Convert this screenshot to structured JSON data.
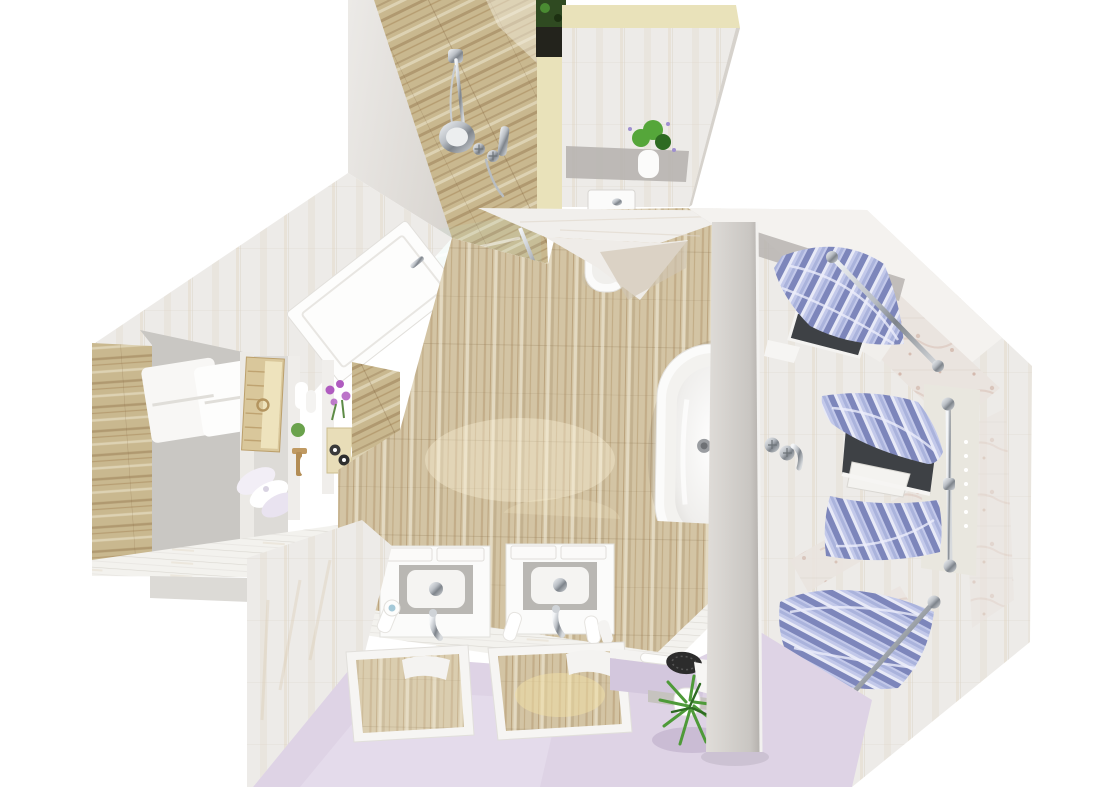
{
  "scene": {
    "title": "Top-down 3D render of an attic bathroom floor plan",
    "view": "bird's-eye / plan perspective",
    "objects": {
      "shower": {
        "label": "walk-in shower with wood-plank wall and chrome shower set"
      },
      "glass_screen": {
        "label": "glass shower screen with chrome rails"
      },
      "wc": {
        "label": "WC compartment with toilet, cistern and potted plant"
      },
      "door": {
        "label": "open white interior door"
      },
      "storage": {
        "label": "open storage shelving with towels, wicker basket and bath accessories"
      },
      "wood_floor": {
        "label": "wood plank bathroom floor"
      },
      "bathtub": {
        "label": "white freestanding bathtub with chrome drain"
      },
      "partition": {
        "label": "partition wall with wall-mounted chrome bath faucet"
      },
      "window_bay": {
        "label": "octagonal window bay with three windows"
      },
      "curtains": {
        "label": "lavender striped swag curtains on chrome rods"
      },
      "vanities": {
        "label": "two white washbasin vanity cabinets with chrome taps"
      },
      "mirrors": {
        "label": "two white framed mirrors reflecting the wood wall"
      },
      "lavender_floor": {
        "label": "pale lavender floor area"
      },
      "bench": {
        "label": "low bench with hairbrush, towel and potted green plant"
      }
    }
  },
  "colors": {
    "bg": "#ffffff",
    "wall_slab": "#e3dfda",
    "pale_tile": "#edebe8",
    "tile_streak": "#d9c8b0",
    "wood_floor": "#d3c4a4",
    "wood_grain": "#a8895c",
    "wood_wall": "#c9b88f",
    "wood_dark": "#8a6c42",
    "cream_band": "#e9e2ba",
    "dark_tile": "#23231c",
    "foliage_dark": "#2f4a21",
    "plant_green": "#55a63a",
    "plant_deep": "#2e6b22",
    "lavender_floor": "#ded3e5",
    "lavender_light": "#eae2f0",
    "counter": "#f3f2ee",
    "counter_line": "#d8d5cf",
    "white_fixture": "#fbfbfa",
    "fixture_shadow": "#dbd9d5",
    "gray_band": "#b7b4b0",
    "marble": "#eae4df",
    "marble_vein": "#c09584",
    "curtain_main": "#9aa3d2",
    "curtain_light": "#e8eaf7",
    "curtain_mid": "#c3c9ea",
    "curtain_deep": "#7d86bb",
    "chrome_light": "#f2f4f6",
    "chrome_mid": "#b0b6bc",
    "chrome_dark": "#7e848b",
    "partition_light": "#dedbd7",
    "partition_dark": "#b5b2ae",
    "basket": "#d9c79b",
    "basket_weave": "#b3945f",
    "purple_flower": "#b05cc0",
    "window_dark": "#3e4145",
    "shadow": "#9d8f7d"
  }
}
